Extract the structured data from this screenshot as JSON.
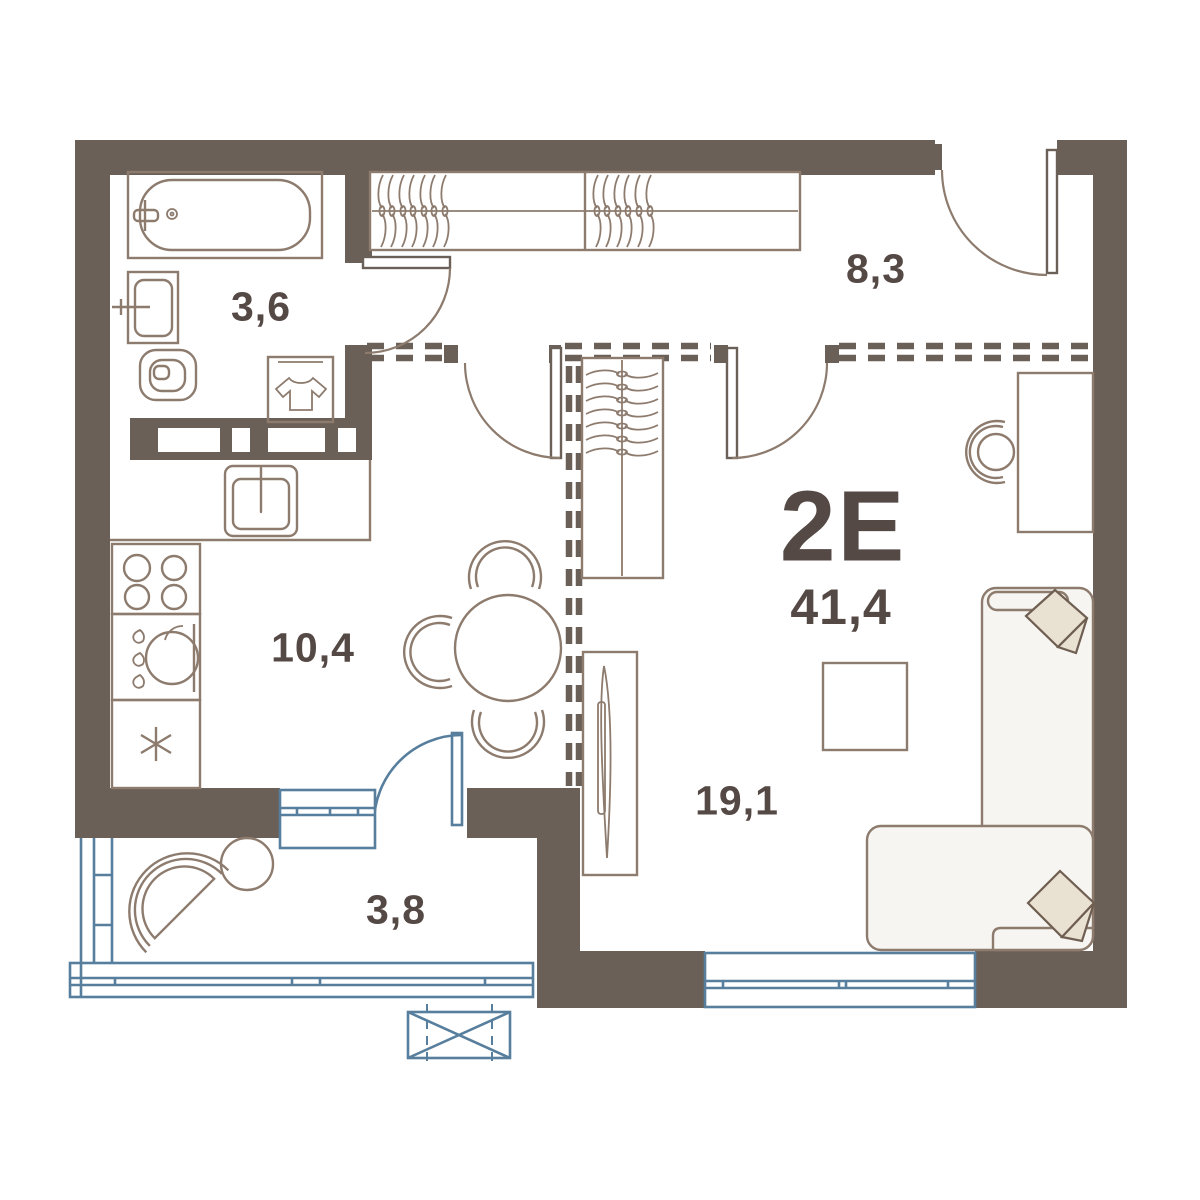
{
  "plan": {
    "type_label": "2Е",
    "total_area": "41,4",
    "rooms": [
      {
        "name": "bathroom",
        "area": "3,6"
      },
      {
        "name": "hallway",
        "area": "8,3"
      },
      {
        "name": "kitchen",
        "area": "10,4"
      },
      {
        "name": "living-room",
        "area": "19,1"
      },
      {
        "name": "balcony",
        "area": "3,8"
      }
    ]
  },
  "icons": {
    "fridge": "snowflake-asterisk",
    "washing-machine": "t-shirt",
    "closet": "clothes-hangers",
    "sink-unit": "water-drops",
    "ac-unit": "crossed-box"
  },
  "colors": {
    "wall": "#6B6057",
    "line": "#8D7B6E",
    "blue": "#577E9D",
    "text": "#554945",
    "sofa": "#F6F5F1",
    "pillow": "#E9E1D1",
    "pillow_line": "#6F5F52",
    "bg": "#FFFFFF"
  }
}
